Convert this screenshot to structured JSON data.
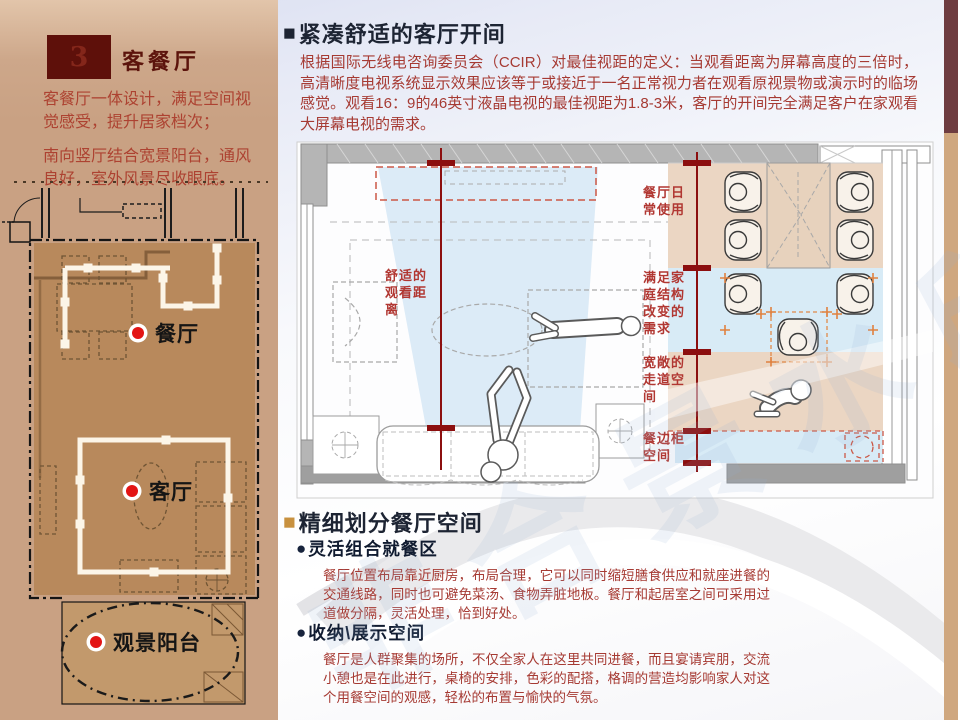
{
  "colors": {
    "panel_tan": "#c9a183",
    "sidebar_maroon": "#6e3c40",
    "sidebar_tan": "#cfa77f",
    "title_box_maroon": "#5e100a",
    "heading_navy": "#1d2433",
    "accent_orange": "#c8913f",
    "body_red": "#a63a33",
    "measure_red": "#8c0f0f",
    "band_tan": "#ebd6c3",
    "band_blue": "#d8ebf6",
    "plan_room_fill": "#b8895c",
    "plan_dot_red": "#e31414"
  },
  "icons": {
    "square_bullet": "■",
    "round_bullet": "●",
    "red_dot": "●"
  },
  "header": {
    "section_number": "3",
    "section_title": "客餐厅"
  },
  "left_panel": {
    "notes": [
      "客餐厅一体设计，满足空间视觉感受，提升居家档次；",
      "南向竖厅结合宽景阳台，通风良好，室外风景尽收眼底。"
    ],
    "plan_labels": {
      "dining": "餐厅",
      "living": "客厅",
      "balcony": "观景阳台"
    }
  },
  "section_living": {
    "heading": "紧凑舒适的客厅开间",
    "body": "根据国际无线电咨询委员会（CCIR）对最佳视距的定义：当观看距离为屏幕高度的三倍时，高清晰度电视系统显示效果应该等于或接近于一名正常视力者在观看原视景物或演示时的临场感觉。观看16：9的46英寸液晶电视的最佳视距为1.8-3米，客厅的开间完全满足客户在家观看大屏幕电视的需求。"
  },
  "diagram": {
    "viewing_label_lines": [
      "舒适的",
      "观看距",
      "离"
    ],
    "bands": [
      {
        "lines": [
          "餐厅日",
          "常使用"
        ]
      },
      {
        "lines": [
          "满足家",
          "庭结构",
          "改变的",
          "需求"
        ]
      },
      {
        "lines": [
          "宽敞的",
          "走道空",
          "间"
        ]
      },
      {
        "lines": [
          "餐边柜",
          "空间"
        ]
      }
    ]
  },
  "section_dining": {
    "heading": "精细划分餐厅空间",
    "bullets": [
      {
        "label": "灵活组合就餐区",
        "body": "餐厅位置布局靠近厨房，布局合理，它可以同时缩短膳食供应和就座进餐的交通线路，同时也可避免菜汤、食物弄脏地板。餐厅和起居室之间可采用过道做分隔，灵活处理，恰到好处。"
      },
      {
        "label": "收纳\\展示空间",
        "body": "餐厅是人群聚集的场所，不仅全家人在这里共同进餐，而且宴请宾朋，交流小憩也是在此进行，桌椅的安排，色彩的配搭，格调的营造均影响家人对这个用餐空间的观感，轻松的布置与愉快的气氛。"
      }
    ]
  },
  "watermark": "非合景水印"
}
